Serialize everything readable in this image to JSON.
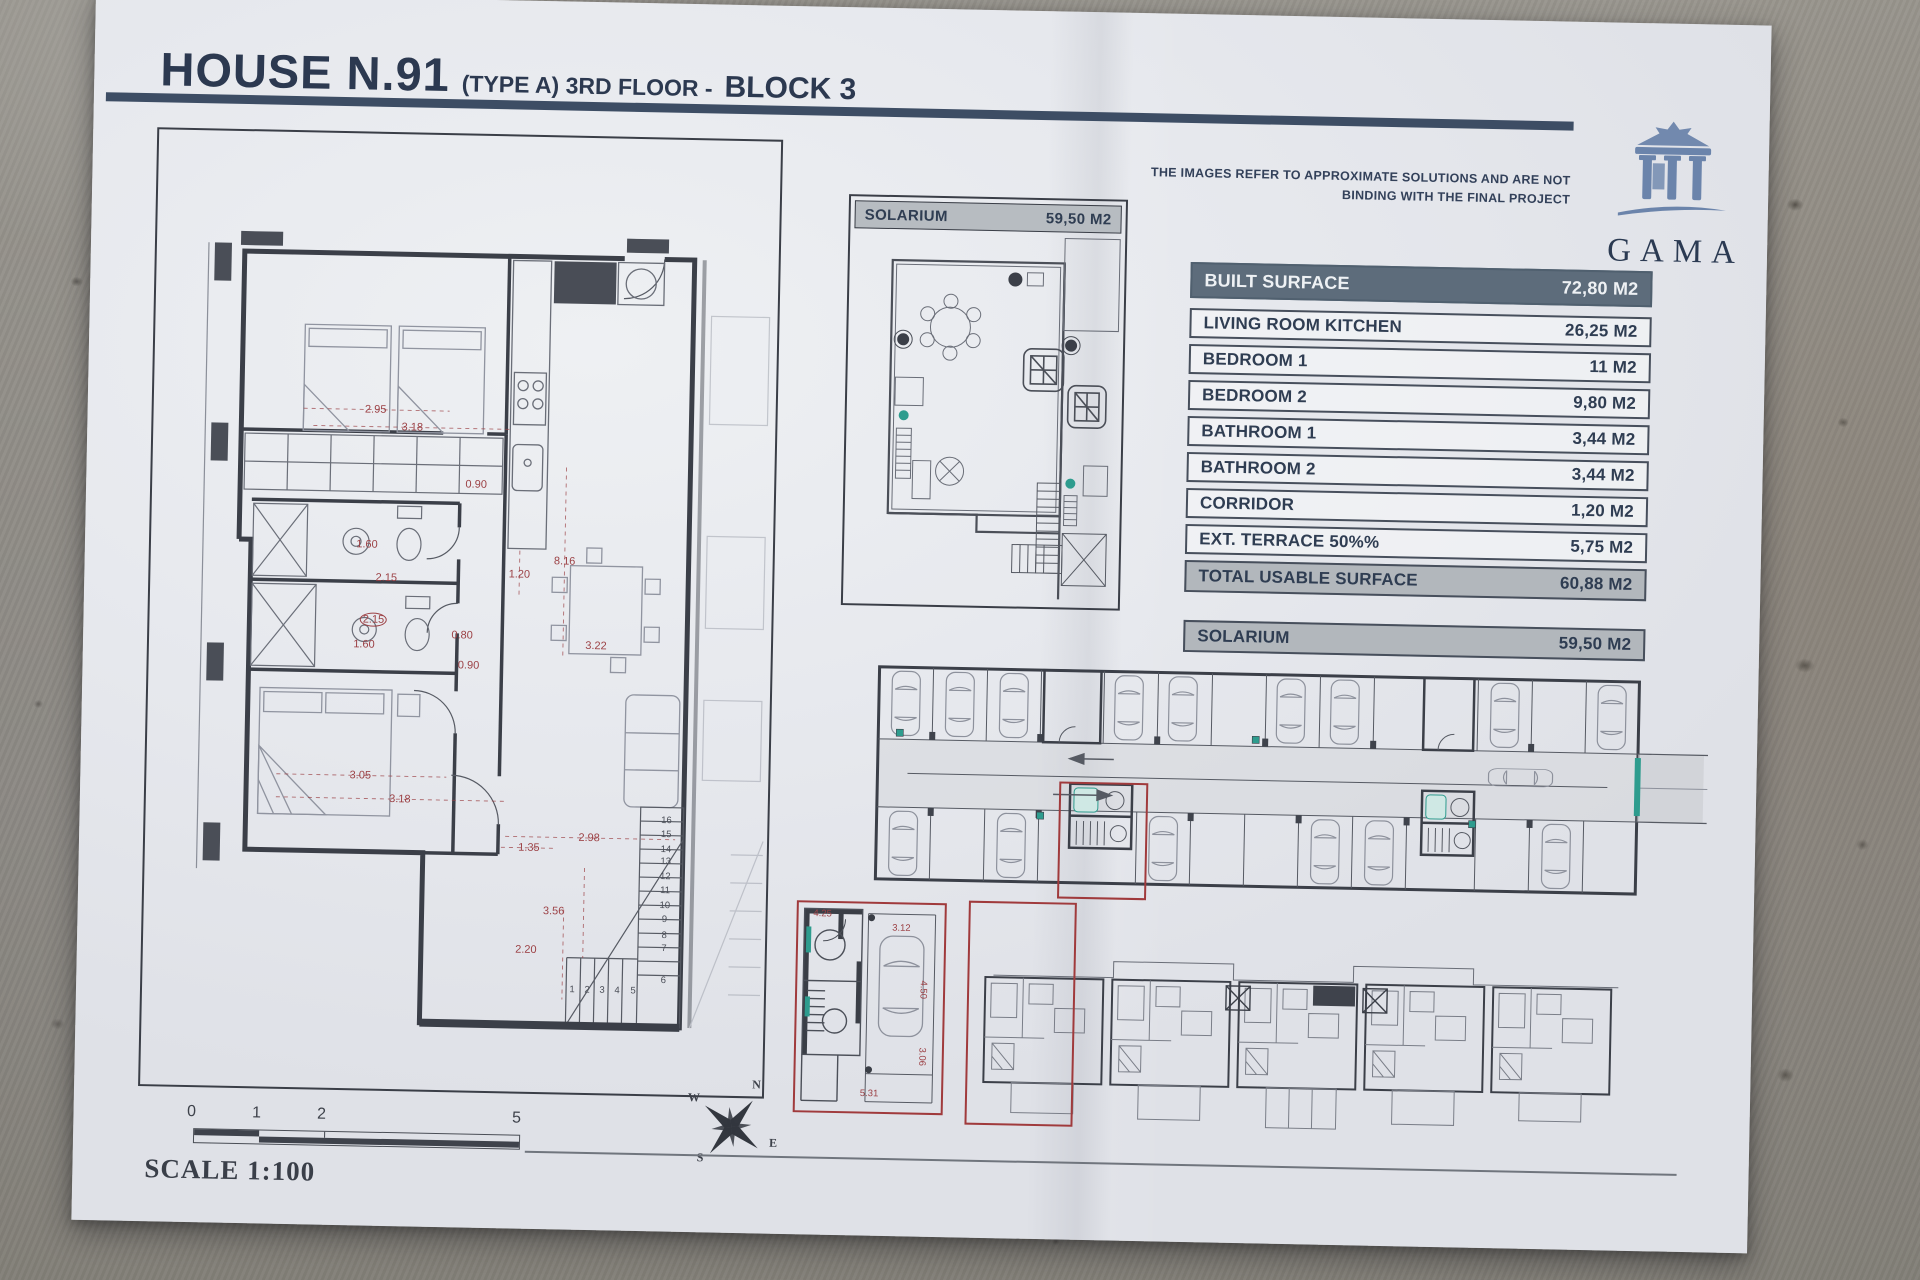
{
  "header": {
    "title_main": "HOUSE N.91",
    "title_sub": "(TYPE A) 3RD FLOOR -",
    "title_block": "BLOCK 3",
    "disclaimer_line1": "THE IMAGES REFER TO APPROXIMATE SOLUTIONS AND ARE NOT",
    "disclaimer_line2": "BINDING WITH THE FINAL PROJECT",
    "logo_text": "GAMA"
  },
  "surface_table": {
    "header": {
      "label": "BUILT SURFACE",
      "value": "72,80 M2"
    },
    "rows": [
      {
        "label": "LIVING ROOM KITCHEN",
        "value": "26,25 M2"
      },
      {
        "label": "BEDROOM 1",
        "value": "11 M2"
      },
      {
        "label": "BEDROOM 2",
        "value": "9,80 M2"
      },
      {
        "label": "BATHROOM 1",
        "value": "3,44 M2"
      },
      {
        "label": "BATHROOM 2",
        "value": "3,44 M2"
      },
      {
        "label": "CORRIDOR",
        "value": "1,20 M2"
      },
      {
        "label": "EXT. TERRACE 50%%",
        "value": "5,75 M2"
      }
    ],
    "total": {
      "label": "TOTAL USABLE SURFACE",
      "value": "60,88 M2"
    },
    "solarium": {
      "label": "SOLARIUM",
      "value": "59,50 M2"
    }
  },
  "solarium_plan": {
    "label": "SOLARIUM",
    "value": "59,50 M2"
  },
  "main_plan": {
    "dimensions": [
      {
        "t": "2.95",
        "x": 222,
        "y": 276
      },
      {
        "t": "3.18",
        "x": 259,
        "y": 293
      },
      {
        "t": "0.90",
        "x": 324,
        "y": 349
      },
      {
        "t": "1.60",
        "x": 216,
        "y": 411
      },
      {
        "t": "2.15",
        "x": 236,
        "y": 444
      },
      {
        "t": "2.15",
        "x": 224,
        "y": 486,
        "c": 1
      },
      {
        "t": "1.60",
        "x": 215,
        "y": 511
      },
      {
        "t": "0.80",
        "x": 313,
        "y": 500
      },
      {
        "t": "0.90",
        "x": 320,
        "y": 530
      },
      {
        "t": "8.16",
        "x": 414,
        "y": 424
      },
      {
        "t": "1.20",
        "x": 369,
        "y": 438
      },
      {
        "t": "3.22",
        "x": 447,
        "y": 508
      },
      {
        "t": "3.05",
        "x": 214,
        "y": 642
      },
      {
        "t": "3.18",
        "x": 254,
        "y": 665
      },
      {
        "t": "2.98",
        "x": 444,
        "y": 700
      },
      {
        "t": "1.35",
        "x": 384,
        "y": 711
      },
      {
        "t": "3.56",
        "x": 410,
        "y": 774
      },
      {
        "t": "2.20",
        "x": 383,
        "y": 813
      }
    ],
    "stair_numbers": [
      {
        "t": "1",
        "x": 430,
        "y": 852
      },
      {
        "t": "2",
        "x": 445,
        "y": 852
      },
      {
        "t": "3",
        "x": 460,
        "y": 852
      },
      {
        "t": "4",
        "x": 475,
        "y": 852
      },
      {
        "t": "5",
        "x": 491,
        "y": 852
      },
      {
        "t": "16",
        "x": 521,
        "y": 681
      },
      {
        "t": "15",
        "x": 521,
        "y": 695
      },
      {
        "t": "14",
        "x": 521,
        "y": 710
      },
      {
        "t": "13",
        "x": 521,
        "y": 722
      },
      {
        "t": "12",
        "x": 521,
        "y": 737
      },
      {
        "t": "11",
        "x": 521,
        "y": 751
      },
      {
        "t": "10",
        "x": 521,
        "y": 766
      },
      {
        "t": "9",
        "x": 521,
        "y": 780
      },
      {
        "t": "8",
        "x": 521,
        "y": 796
      },
      {
        "t": "7",
        "x": 521,
        "y": 809
      },
      {
        "t": "6",
        "x": 521,
        "y": 841
      }
    ]
  },
  "garage_detail": {
    "dimensions": [
      {
        "t": "4.25",
        "x": 24,
        "y": 11
      },
      {
        "t": "3.12",
        "x": 103,
        "y": 24
      },
      {
        "t": "4.50",
        "x": 126,
        "y": 85,
        "r": 90
      },
      {
        "t": "3.06",
        "x": 126,
        "y": 152,
        "r": 90
      },
      {
        "t": "5.31",
        "x": 74,
        "y": 190
      }
    ]
  },
  "compass": {
    "n": "N",
    "e": "E",
    "s": "S",
    "w": "W"
  },
  "scale": {
    "label": "SCALE 1:100",
    "ticks": [
      {
        "t": "0",
        "x": 46,
        "y": 10
      },
      {
        "t": "1",
        "x": 111,
        "y": 10
      },
      {
        "t": "2",
        "x": 176,
        "y": 10
      },
      {
        "t": "5",
        "x": 371,
        "y": 10
      }
    ]
  },
  "colors": {
    "accent_red": "#a03a3c",
    "dimension_red": "#9c4145",
    "teal": "#2e9c8e",
    "navy": "#2e3c55",
    "table_header_bg": "#5d6c7b",
    "gray_row_bg": "#b2b7bc",
    "logo_blue": "#6b84ab"
  }
}
